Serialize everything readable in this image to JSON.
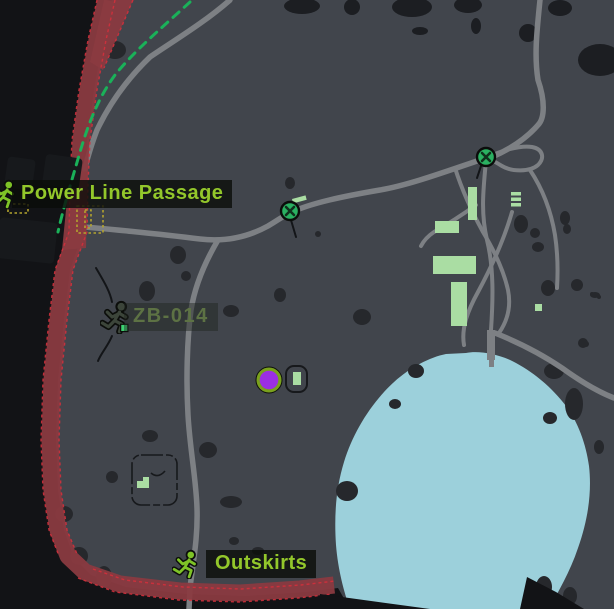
{
  "labels": {
    "power_line_passage": "Power Line Passage",
    "zb014": "ZB-014",
    "outskirts": "Outskirts"
  },
  "icons": {
    "extraction": "runner-icon",
    "switch_marker": "green-circle-x-icon",
    "position_marker": "purple-dot"
  },
  "colors": {
    "out_of_bounds": "#121316",
    "land": "#41454c",
    "tree": "#1c1e22",
    "rock": "#26282c",
    "road": "#7d8084",
    "water": "#9cd0db",
    "building": "#aadda3",
    "restricted": "#8a3a40",
    "restricted_edge": "#d3303c",
    "path_green": "#1ab159",
    "quest_yellow": "#b3a42e",
    "label_text": "#93c72b",
    "label_dim": "#5d7244",
    "label_bg": "rgba(10,12,9,0.8)",
    "marker_green": "#2ab061",
    "marker_purple": "#9b2fe3",
    "marker_ring": "#7aa11d",
    "icon_green": "#7ec327",
    "icon_dark": "#3c453a"
  }
}
